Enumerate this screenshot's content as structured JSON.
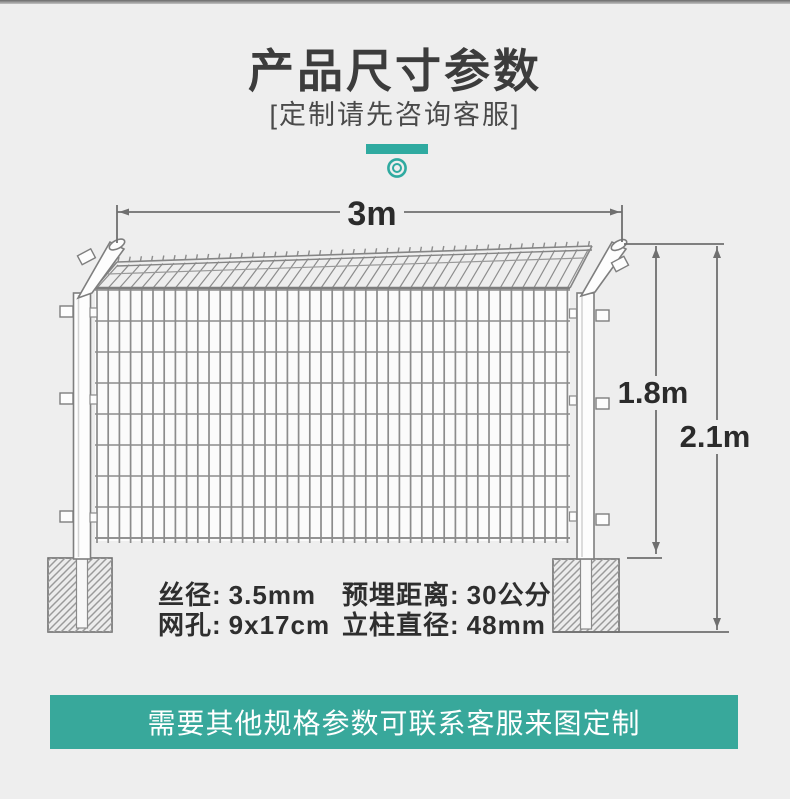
{
  "header": {
    "title": "产品尺寸参数",
    "subtitle": "[定制请先咨询客服]"
  },
  "diagram": {
    "width_label": "3m",
    "mesh_height_label": "1.8m",
    "total_height_label": "2.1m"
  },
  "specs": {
    "items": [
      {
        "label": "丝径:",
        "value": "3.5mm"
      },
      {
        "label": "网孔:",
        "value": "9x17cm"
      },
      {
        "label": "预埋距离:",
        "value": "30公分"
      },
      {
        "label": "立柱直径:",
        "value": "48mm"
      }
    ]
  },
  "banner": {
    "text": "需要其他规格参数可联系客服来图定制"
  },
  "colors": {
    "background": "#eeeeee",
    "accent": "#2faaa0",
    "banner": "#38a89b",
    "line": "#6f6f6f",
    "wire": "#8c8c8c"
  }
}
